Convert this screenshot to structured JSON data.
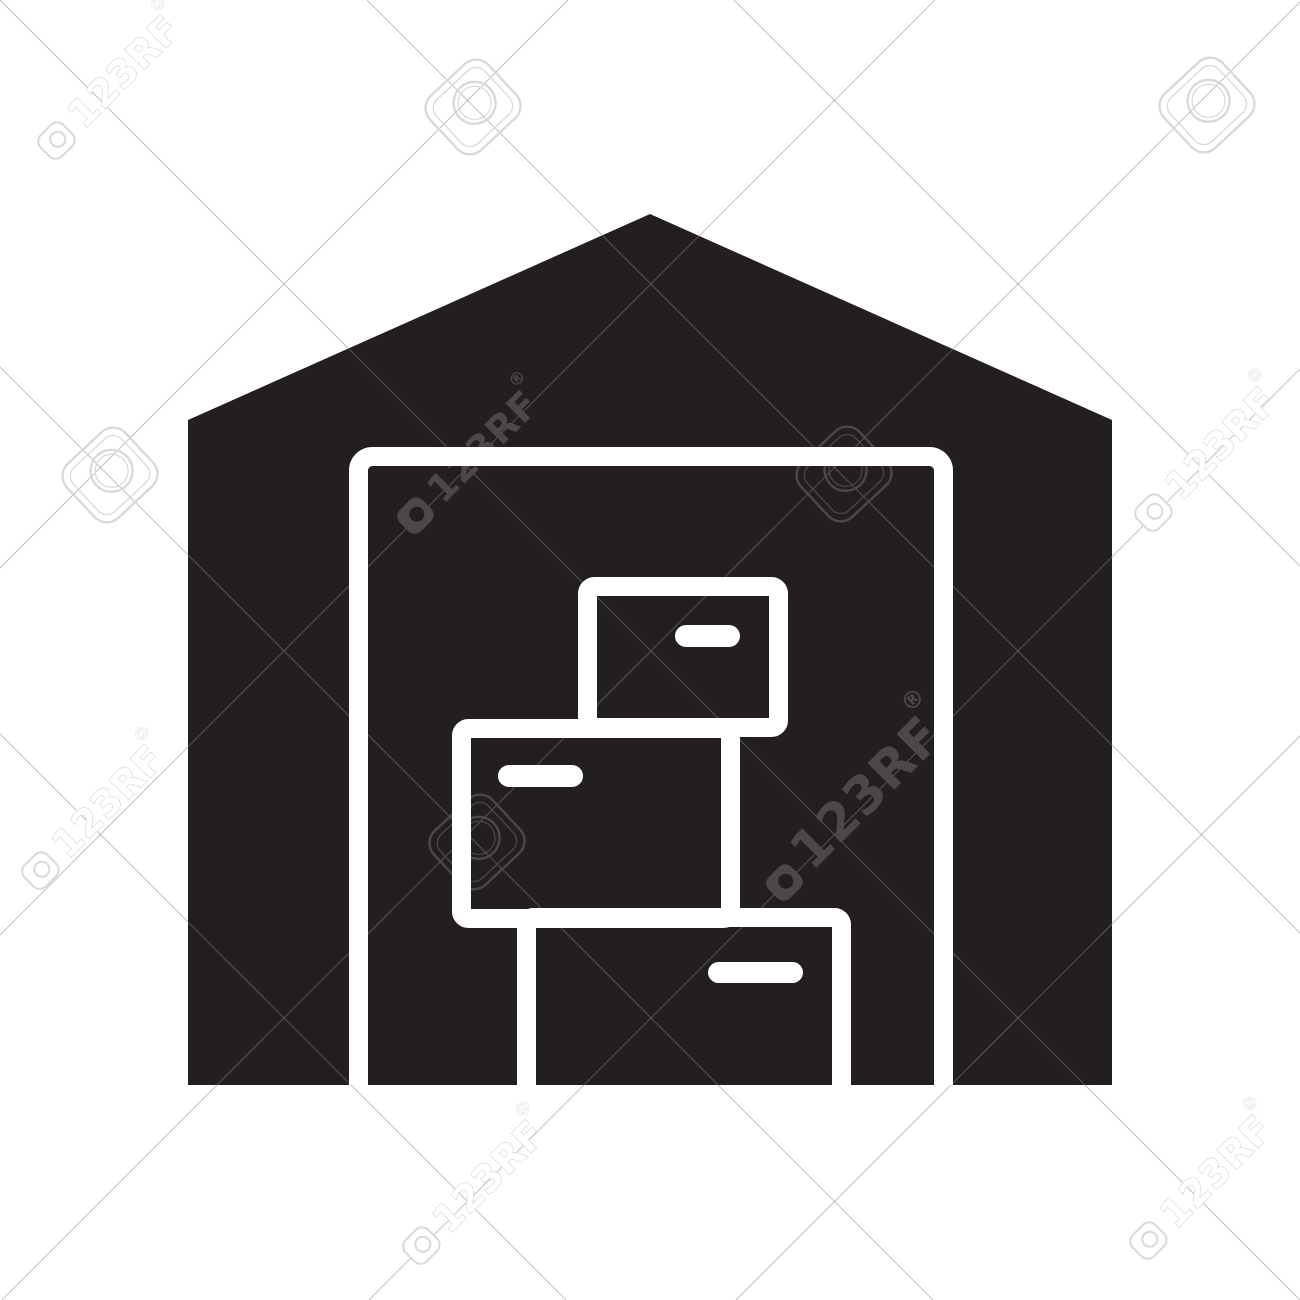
{
  "page": {
    "width": 1300,
    "height": 1300,
    "background_color": "#ffffff",
    "description": "Black glyph icon of a warehouse with stacked boxes, covered by 123RF stock-photo watermarks"
  },
  "icon": {
    "name": "warehouse-boxes-glyph",
    "fill_color": "#231f20",
    "stroke_color": "#ffffff",
    "stroke_width": 19,
    "building": {
      "peak": [
        650,
        214
      ],
      "left_shoulder": [
        188,
        420
      ],
      "right_shoulder": [
        1112,
        420
      ],
      "base_y": 1085
    },
    "door": {
      "outer_x": 349,
      "outer_y": 447,
      "outer_w": 604,
      "corner_radius": 14
    },
    "boxes": [
      {
        "name": "top-box",
        "x": 578,
        "y": 577,
        "w": 210,
        "h": 160,
        "dash": {
          "x": 675,
          "y": 625,
          "w": 65,
          "h": 22
        }
      },
      {
        "name": "middle-box",
        "x": 452,
        "y": 719,
        "w": 288,
        "h": 209,
        "dash": {
          "x": 498,
          "y": 765,
          "w": 85,
          "h": 22
        }
      },
      {
        "name": "bottom-box",
        "x": 517,
        "y": 908,
        "w": 334,
        "h": 215,
        "dash": {
          "x": 708,
          "y": 962,
          "w": 95,
          "h": 21
        }
      }
    ]
  },
  "watermark": {
    "brand_text": "123RF",
    "registered_mark": "®",
    "colors": {
      "light_stroke": "#d9d9d9",
      "light_fill": "#ffffff",
      "dark_fill": "#4c4849",
      "hairline": "rgba(136,136,136,0.5)"
    },
    "text_units": [
      {
        "x": 84,
        "y": 130,
        "font_size": 38,
        "theme": "light"
      },
      {
        "x": 443,
        "y": 505,
        "font_size": 38,
        "theme": "dark"
      },
      {
        "x": 68,
        "y": 860,
        "font_size": 38,
        "theme": "light"
      },
      {
        "x": 812,
        "y": 872,
        "font_size": 52,
        "theme": "dark"
      },
      {
        "x": 449,
        "y": 1235,
        "font_size": 38,
        "theme": "light"
      },
      {
        "x": 1176,
        "y": 1230,
        "font_size": 38,
        "theme": "light"
      },
      {
        "x": 1181,
        "y": 502,
        "font_size": 38,
        "theme": "light"
      }
    ],
    "logo_marks": [
      {
        "cx": 473,
        "cy": 107,
        "scale": 1.0,
        "theme": "light"
      },
      {
        "cx": 1207,
        "cy": 105,
        "scale": 1.0,
        "theme": "light"
      },
      {
        "cx": 110,
        "cy": 475,
        "scale": 1.0,
        "theme": "light"
      },
      {
        "cx": 844,
        "cy": 474,
        "scale": 1.0,
        "theme": "dark"
      },
      {
        "cx": 477,
        "cy": 842,
        "scale": 1.0,
        "theme": "dark"
      }
    ],
    "hairlines": {
      "diagonal_offsets": [
        -734,
        -367,
        0,
        367,
        734
      ],
      "antidiagonal_sums": [
        568,
        935,
        1302,
        1669,
        2036
      ]
    }
  }
}
